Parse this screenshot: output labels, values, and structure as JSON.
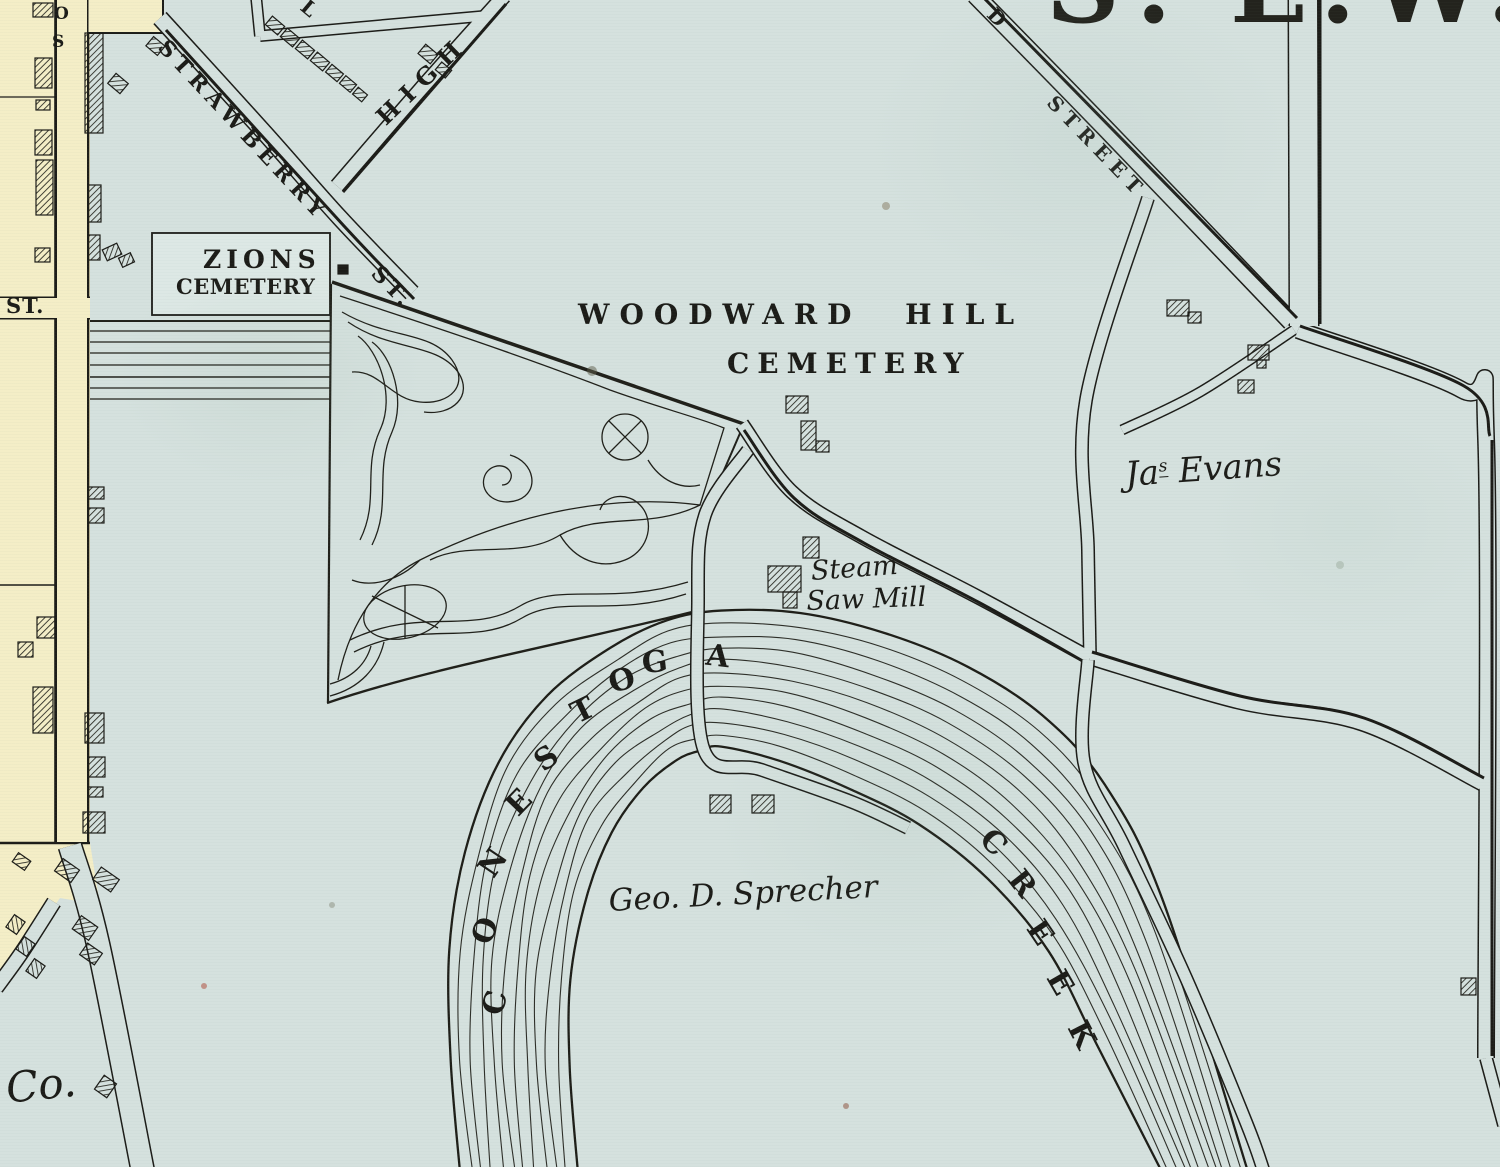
{
  "map": {
    "ward_letters": [
      "S",
      ".",
      "E",
      ".",
      "W",
      "."
    ],
    "streets": {
      "strawberry": "STRAWBERRY",
      "strawberry_st": "ST.",
      "high": "HIGH",
      "partial_l": "L",
      "street_d": "D",
      "street": "STREET",
      "left_st": "ST.",
      "vertical_letters": [
        "O",
        "S"
      ]
    },
    "places": {
      "zions_line1": "ZIONS",
      "zions_line2": "CEMETERY",
      "woodward_line1": "WOODWARD HILL",
      "woodward_line2": "CEMETERY",
      "jas_evans": {
        "prefix": "Ja",
        "sup": "s",
        "rest": " Evans"
      },
      "steam": "Steam",
      "saw_mill": "Saw Mill",
      "sprecher": "Geo. D. Sprecher",
      "co": "Co."
    },
    "water": {
      "conestoga": [
        "C",
        "O",
        "N",
        "E",
        "S",
        "T",
        "O",
        "G",
        "A"
      ],
      "creek": [
        "C",
        "R",
        "E",
        "E",
        "K"
      ]
    },
    "colors": {
      "paper_blue": "#d5e1de",
      "paper_yellow": "#f4eec7",
      "ink": "#1c1c18"
    }
  }
}
